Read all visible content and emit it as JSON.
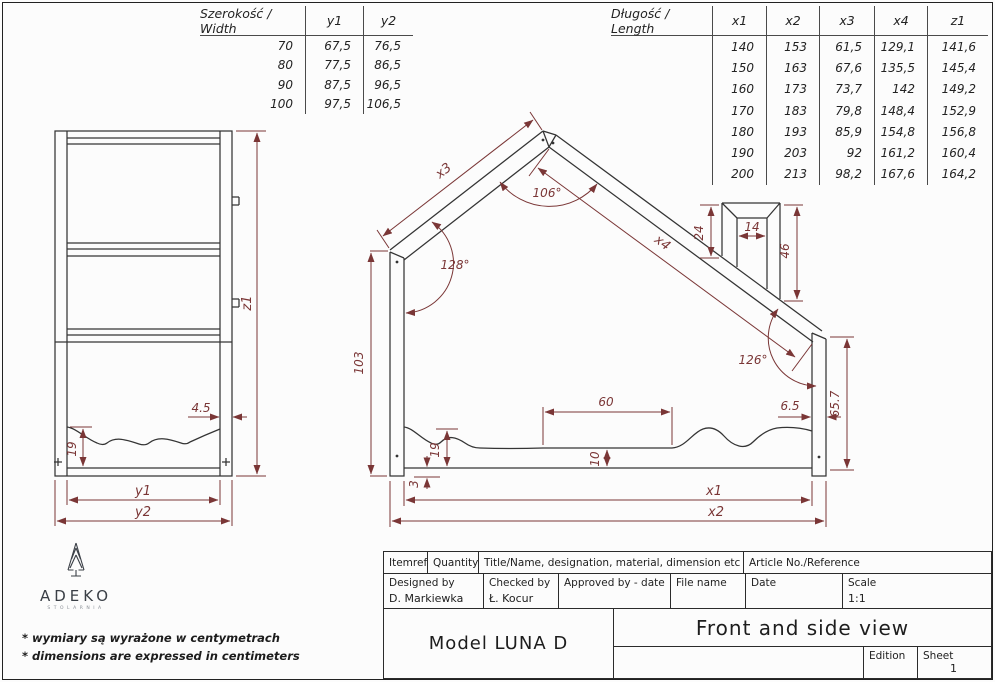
{
  "colors": {
    "dimension_red": "#7a3636",
    "line_black": "#343434"
  },
  "width_table": {
    "header": [
      "Szerokość / Width",
      "y1",
      "y2"
    ],
    "rows": [
      [
        "70",
        "67,5",
        "76,5"
      ],
      [
        "80",
        "77,5",
        "86,5"
      ],
      [
        "90",
        "87,5",
        "96,5"
      ],
      [
        "100",
        "97,5",
        "106,5"
      ]
    ]
  },
  "length_table": {
    "header": [
      "Długość / Length",
      "x1",
      "x2",
      "x3",
      "x4",
      "z1"
    ],
    "rows": [
      [
        "",
        "140",
        "153",
        "61,5",
        "129,1",
        "141,6"
      ],
      [
        "",
        "150",
        "163",
        "67,6",
        "135,5",
        "145,4"
      ],
      [
        "",
        "160",
        "173",
        "73,7",
        "142",
        "149,2"
      ],
      [
        "",
        "170",
        "183",
        "79,8",
        "148,4",
        "152,9"
      ],
      [
        "",
        "180",
        "193",
        "85,9",
        "154,8",
        "156,8"
      ],
      [
        "",
        "190",
        "203",
        "92",
        "161,2",
        "160,4"
      ],
      [
        "",
        "200",
        "213",
        "98,2",
        "167,6",
        "164,2"
      ]
    ]
  },
  "side_view": {
    "z1": "z1",
    "post_width": "4.5",
    "wave_height": "19",
    "y1": "y1",
    "y2": "y2"
  },
  "front_view": {
    "x3": "x3",
    "x4": "x4",
    "peak_angle": "106°",
    "left_eave_angle": "128°",
    "right_eave_angle": "126°",
    "left_post_height": "103",
    "right_post_height": "65.7",
    "chimney_left": "24",
    "chimney_width": "14",
    "chimney_right": "46",
    "opening_width": "60",
    "wave_height": "19",
    "rail_height": "10",
    "foot_gap": "3",
    "post_width": "6.5",
    "x1": "x1",
    "x2": "x2"
  },
  "logo": {
    "name": "ADEKO",
    "subtitle": "STOLARNIA"
  },
  "notes": {
    "line1": "* wymiary są wyrażone w centymetrach",
    "line2": "* dimensions are expressed in centimeters"
  },
  "title_block": {
    "itemref_label": "Itemref",
    "quantity_label": "Quantity",
    "title_name_label": "Title/Name, designation, material, dimension etc",
    "article_label": "Article No./Reference",
    "designed_by_label": "Designed by",
    "designed_by_value": "D. Markiewka",
    "checked_by_label": "Checked by",
    "checked_by_value": "Ł. Kocur",
    "approved_by_label": "Approved by - date",
    "file_name_label": "File name",
    "date_label": "Date",
    "scale_label": "Scale",
    "scale_value": "1:1",
    "model_name": "Model LUNA D",
    "view_title": "Front and side view",
    "edition_label": "Edition",
    "sheet_label": "Sheet",
    "sheet_value": "1"
  }
}
